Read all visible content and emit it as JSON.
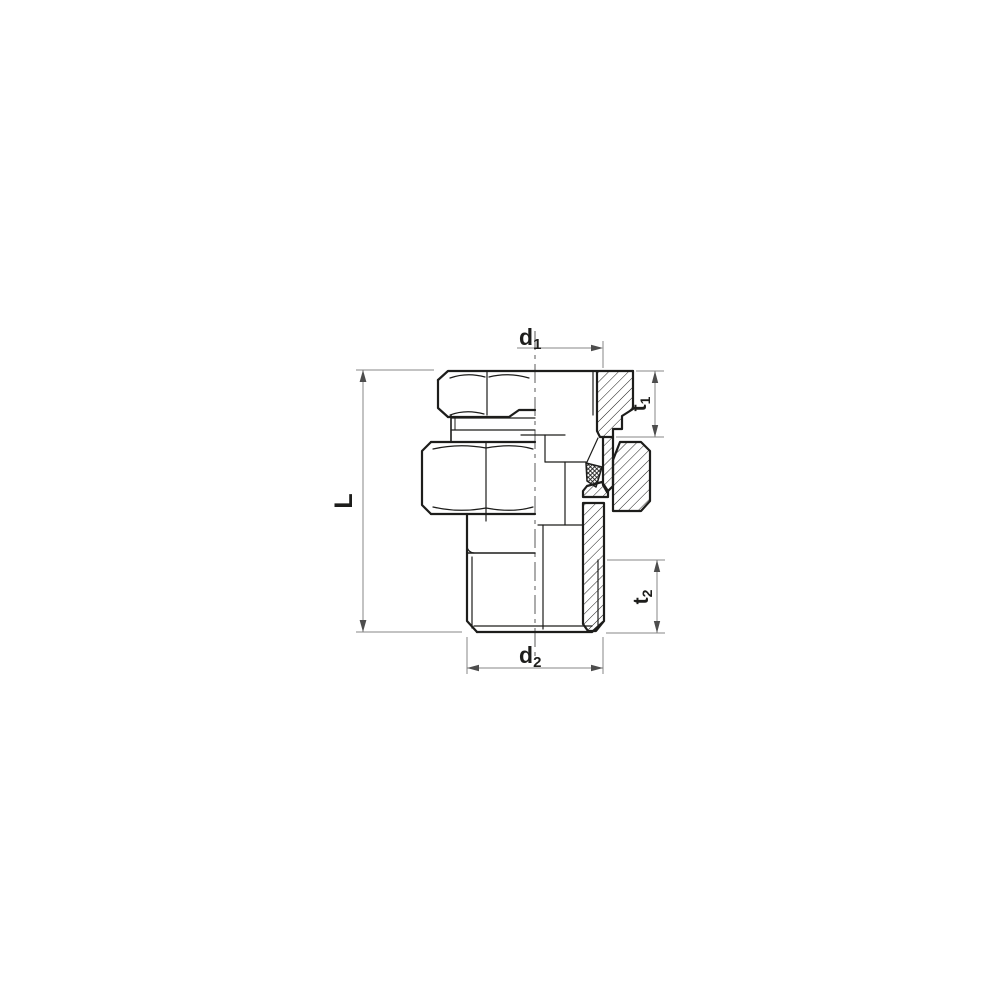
{
  "dimensions": {
    "d1": {
      "base": "d",
      "sub": "1"
    },
    "t1": {
      "base": "t",
      "sub": "1"
    },
    "t2": {
      "base": "t",
      "sub": "2"
    },
    "d2": {
      "base": "d",
      "sub": "2"
    },
    "L": {
      "base": "L"
    }
  },
  "colors": {
    "background": "#ffffff",
    "part_line": "#1d1d1b",
    "dimension_line": "#878787",
    "arrow": "#4d4d4d",
    "label_text": "#1d1d1b",
    "centerline": "#5a5a5a"
  }
}
